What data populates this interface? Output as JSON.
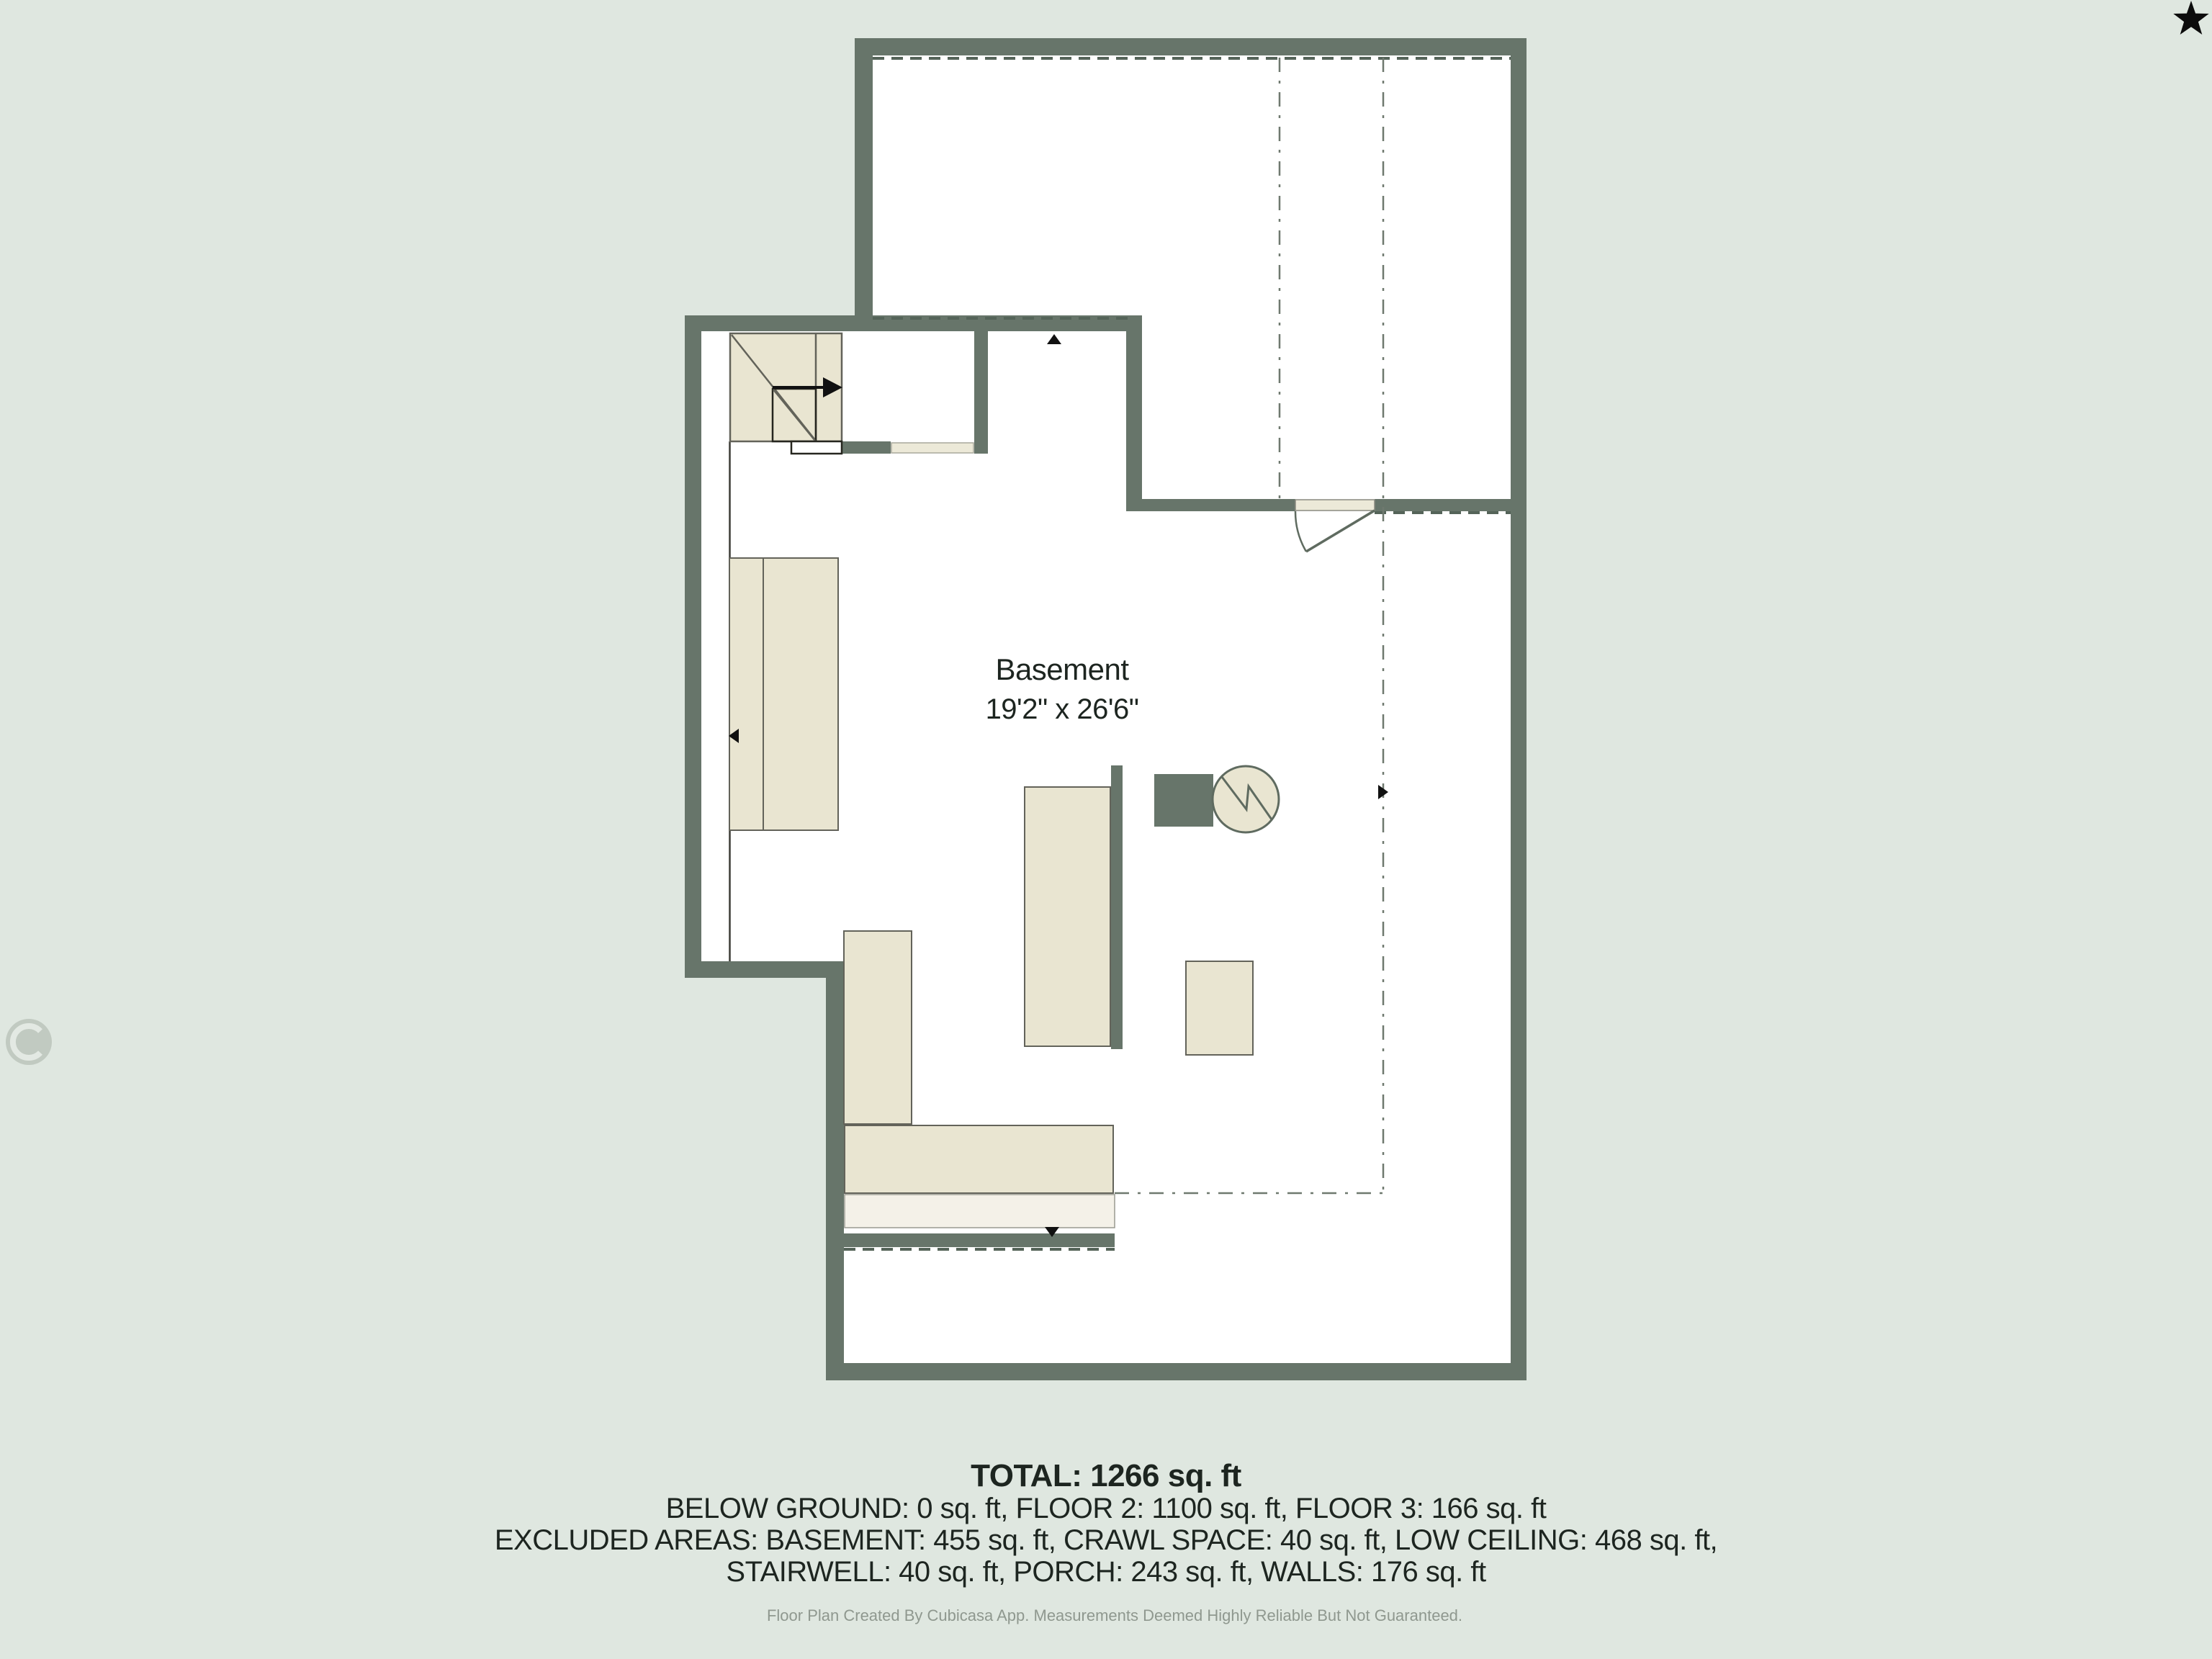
{
  "floor_plan": {
    "room_label": "Basement",
    "room_dimensions": "19'2\" x 26'6\""
  },
  "summary": {
    "total_line": "TOTAL: 1266 sq. ft",
    "floors_line": "BELOW GROUND: 0 sq. ft, FLOOR 2: 1100 sq. ft, FLOOR 3: 166 sq. ft",
    "excluded_line_1": "EXCLUDED AREAS: BASEMENT: 455 sq. ft, CRAWL SPACE: 40 sq. ft, LOW CEILING: 468 sq. ft,",
    "excluded_line_2": "STAIRWELL: 40 sq. ft, PORCH: 243 sq. ft, WALLS: 176 sq. ft"
  },
  "footer": {
    "disclaimer": "Floor Plan Created By Cubicasa App. Measurements Deemed Highly Reliable But Not Guaranteed."
  },
  "icons": {
    "star": "star-icon",
    "stair_direction": "stair-direction-arrow-icon",
    "dimension_markers": [
      "dimension-arrow-left-icon",
      "dimension-arrow-right-icon",
      "dimension-arrow-up-icon",
      "dimension-arrow-down-icon"
    ],
    "furnace": "furnace-water-heater-icon",
    "logo": "cubicasa-logo-watermark"
  },
  "colors": {
    "bg": "#dfe7e0",
    "wall": "#67756a",
    "white": "#ffffff",
    "furn": "#e9e5d1",
    "furn-light": "#f4f1e8",
    "sill": "#ece9d8",
    "outline": "#63635a",
    "thin": "#3c3c36",
    "dim": "#6f796f",
    "dash": "#556459",
    "text": "#1d2520",
    "muted": "#8f988f",
    "arrow": "#111111",
    "symbol": "#5f6b60"
  }
}
